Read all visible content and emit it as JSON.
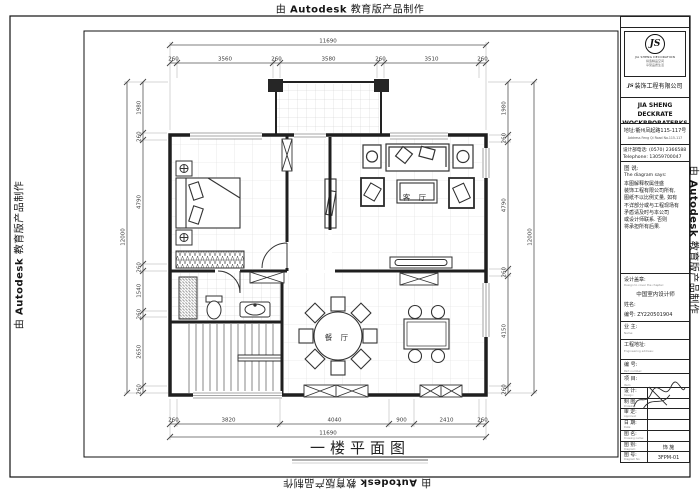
{
  "watermark": {
    "prefix": "由",
    "brand": "Autodesk",
    "suffix": "教育版产品制作"
  },
  "plan": {
    "labels": {
      "living_room": "客 厅",
      "dining_room": "餐 厅"
    },
    "title": "一楼平面图"
  },
  "dimensions": {
    "top": {
      "overall": "11690",
      "segments": [
        "260",
        "3560",
        "260",
        "3580",
        "260",
        "3510",
        "260"
      ]
    },
    "bottom": {
      "overall": "11690",
      "segments": [
        "260",
        "3820",
        "4040",
        "900",
        "2410",
        "260"
      ]
    },
    "left": {
      "overall": "12000",
      "segments": [
        "1980",
        "260",
        "4790",
        "260",
        "1540",
        "260",
        "2650",
        "260"
      ]
    },
    "right": {
      "overall": "12000",
      "segments": [
        "1980",
        "260",
        "4790",
        "260",
        "4150",
        "260"
      ]
    }
  },
  "title_block": {
    "logo": {
      "monogram": "JS",
      "caption": "JIA SHENG DECORATION",
      "slogan1": "缔造精品空间",
      "slogan2": "享受品质生活",
      "company_cn": "装饰工程有限公司"
    },
    "company_en_1": "JIA SHENG DECKRATE",
    "company_en_2": "WOCKRPORATERKS",
    "address_cn": "地址:衢州凤起路115-117号",
    "address_en": "Address Feng Qi Road No.115-117",
    "phone_cn": "设计部电话:  (0570) 2366588",
    "phone_en": "Telephone:  13059700047",
    "diagram_says_cn": "图  说:",
    "diagram_says_en": "The diagram says:",
    "disclaimer_lines": [
      "本图解释权属佳盛",
      "装饰工程有限公司所有,",
      "图纸不以比例丈量, 如有",
      "不详部分或与工程现场有",
      "矛盾请及时与本公司",
      "或设计师联系. 否则",
      "将承担所有后果."
    ],
    "seal": {
      "label_cn": "设计盖章:",
      "label_en": "Design to cover the chapter:",
      "line1": "中国室内设计师",
      "name": "姓名:",
      "number": "编号: ZY220501904"
    },
    "rows": {
      "owner": {
        "cn": "业  主:",
        "en": "Name:"
      },
      "site": {
        "cn": "工程地址:",
        "en": "Engineering address:"
      },
      "serial": {
        "cn": "编  号:",
        "en": "Part number:"
      },
      "item": {
        "cn": "项  目:",
        "en": "Item:"
      },
      "design": {
        "cn": "设 计:",
        "en": "Design:",
        "value": ""
      },
      "draft": {
        "cn": "制 图:",
        "en": "Drawing:",
        "value": ""
      },
      "approve": {
        "cn": "审 定:",
        "en": "Approval:",
        "value": ""
      },
      "date": {
        "cn": "日 期:",
        "en": "Date:",
        "value": ""
      },
      "dwg_name": {
        "cn": "图 名:",
        "en": "Drawing name:",
        "value": ""
      },
      "dwg_type": {
        "cn": "图 别:",
        "en": "Diagram:",
        "value": "饰 施"
      },
      "dwg_no": {
        "cn": "图 号:",
        "en": "Diagram No:",
        "value": "3FPM-01"
      }
    }
  }
}
